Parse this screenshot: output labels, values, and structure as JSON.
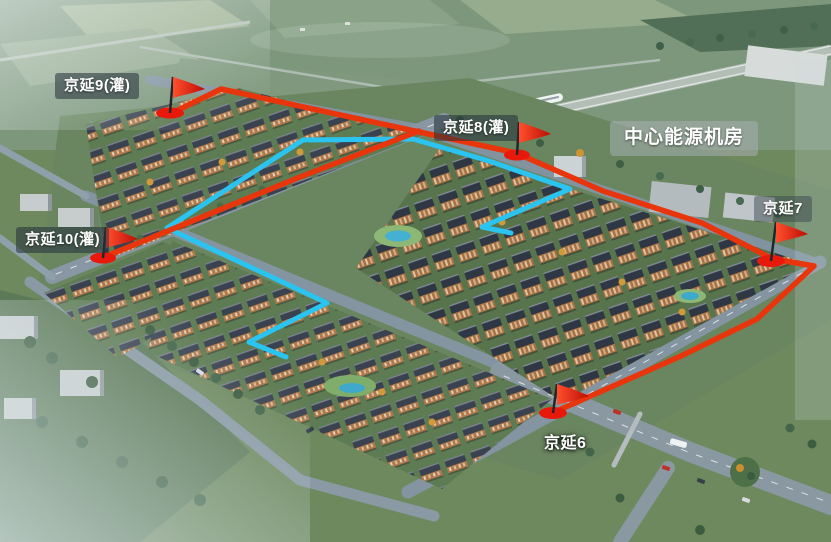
{
  "scene": {
    "energy_center_label": "中心能源机房",
    "stations": [
      {
        "name": "京延9(灌)"
      },
      {
        "name": "京延8(灌)"
      },
      {
        "name": "京延7"
      },
      {
        "name": "京延10(灌)"
      },
      {
        "name": "京延6"
      }
    ],
    "colors": {
      "route_supply": "#e8350c",
      "route_branch": "#2bc3f0",
      "flag": "#e8190b",
      "label_text": "#ffffff"
    }
  }
}
